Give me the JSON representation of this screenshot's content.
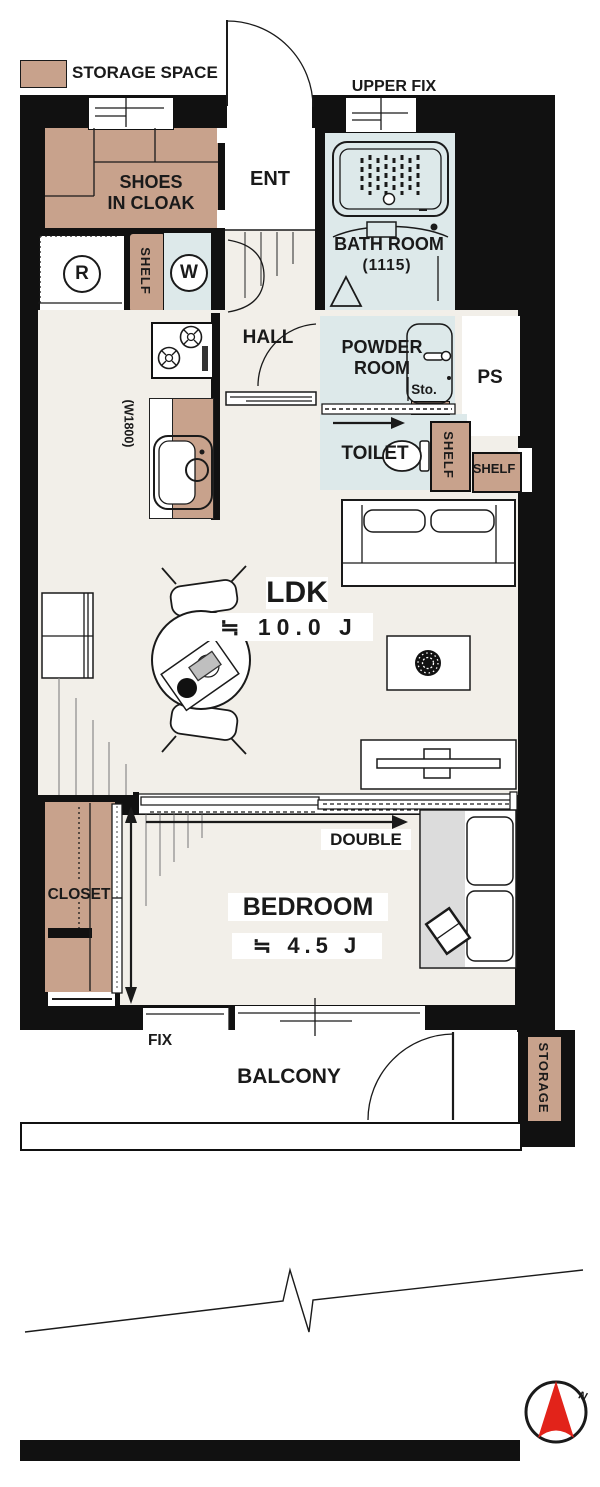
{
  "legend": {
    "label": "STORAGE SPACE"
  },
  "plan": {
    "ent": "ENT",
    "hall": "HALL",
    "upper_fix": "UPPER FIX",
    "shoes_line1": "SHOES",
    "shoes_line2": "IN CLOAK",
    "bath_name": "BATH ROOM",
    "bath_size": "(1115)",
    "powder_line1": "POWDER",
    "powder_line2": "ROOM",
    "sto": "Sto.",
    "ps": "PS",
    "toilet": "TOILET",
    "shelf_laundry": "SHELF",
    "shelf_toilet": "SHELF",
    "shelf_wall": "SHELF",
    "fridge": "R",
    "washer": "W",
    "kitchen_width": "(W1800)",
    "ldk_name": "LDK",
    "ldk_area": "≒ 10.0 J",
    "bedroom_name": "BEDROOM",
    "bedroom_area": "≒ 4.5 J",
    "bed_size": "DOUBLE",
    "closet": "CLOSET",
    "fix": "FIX",
    "balcony": "BALCONY",
    "storage": "STORAGE",
    "north": "N"
  },
  "colors": {
    "storage_fill": "#c8a28c",
    "wet_area_fill": "#dde9ea",
    "floor_fill": "#f2efe9",
    "wall": "#111111",
    "compass_red": "#e2231a",
    "bed_runner": "#dcdcdc"
  }
}
